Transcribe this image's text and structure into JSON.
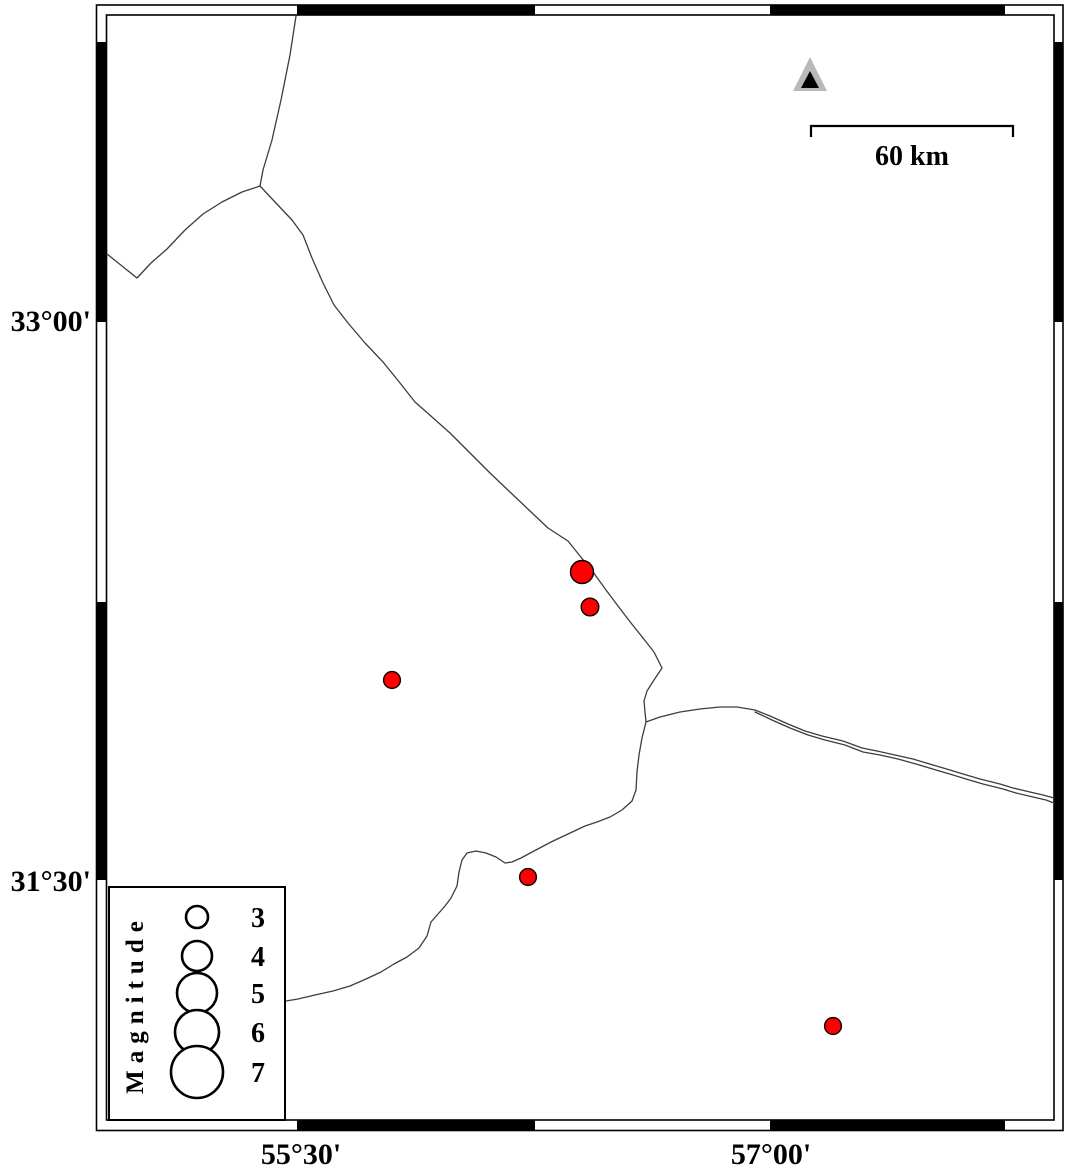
{
  "figure": {
    "width": 1066,
    "height": 1173,
    "background": "#ffffff"
  },
  "map": {
    "frame": {
      "color": "#000000",
      "stroke_width": 1.6,
      "outer": {
        "x1": 96.5,
        "y1": 5,
        "x2": 1063,
        "y2": 1130.5
      },
      "inner": {
        "x1": 106.5,
        "y1": 15,
        "x2": 1054,
        "y2": 1120
      },
      "h_black_segments": [
        [
          297,
          535
        ],
        [
          770,
          1005
        ]
      ],
      "v_black_segments": [
        [
          42,
          322
        ],
        [
          602,
          880
        ]
      ]
    },
    "axis_labels": {
      "left": [
        {
          "text": "33°00'",
          "x": 91,
          "y": 331
        },
        {
          "text": "31°30'",
          "x": 91,
          "y": 891
        }
      ],
      "bottom": [
        {
          "text": "55°30'",
          "x": 301,
          "y": 1164
        },
        {
          "text": "57°00'",
          "x": 771,
          "y": 1164
        }
      ],
      "font_size": 30
    },
    "fault_style": {
      "color": "#3d3d3d",
      "width": 1.3
    },
    "faults": [
      {
        "name": "north-branch",
        "points": [
          [
            296,
            16
          ],
          [
            290,
            55
          ],
          [
            281,
            100
          ],
          [
            272,
            140
          ],
          [
            263,
            170
          ],
          [
            260,
            186
          ]
        ]
      },
      {
        "name": "west-branch",
        "points": [
          [
            107,
            254
          ],
          [
            122,
            266
          ],
          [
            137,
            278
          ],
          [
            151,
            263
          ],
          [
            167,
            249
          ],
          [
            185,
            230
          ],
          [
            203,
            214
          ],
          [
            222,
            202
          ],
          [
            242,
            192
          ],
          [
            260,
            186
          ]
        ]
      },
      {
        "name": "main-diagonal",
        "points": [
          [
            260,
            186
          ],
          [
            275,
            202
          ],
          [
            292,
            220
          ],
          [
            303,
            235
          ],
          [
            312,
            258
          ],
          [
            323,
            283
          ],
          [
            334,
            305
          ],
          [
            348,
            323
          ],
          [
            365,
            343
          ],
          [
            383,
            362
          ],
          [
            400,
            383
          ],
          [
            415,
            402
          ],
          [
            432,
            417
          ],
          [
            450,
            433
          ],
          [
            470,
            453
          ],
          [
            490,
            473
          ],
          [
            510,
            492
          ],
          [
            530,
            511
          ],
          [
            548,
            528
          ],
          [
            568,
            541
          ],
          [
            580,
            556
          ],
          [
            593,
            572
          ],
          [
            606,
            590
          ],
          [
            618,
            606
          ],
          [
            631,
            623
          ],
          [
            643,
            638
          ],
          [
            654,
            652
          ],
          [
            662,
            668
          ],
          [
            654,
            680
          ],
          [
            647,
            691
          ],
          [
            644,
            701
          ],
          [
            645,
            712
          ],
          [
            646,
            722
          ],
          [
            642,
            738
          ],
          [
            639,
            755
          ],
          [
            637,
            772
          ],
          [
            636,
            790
          ],
          [
            632,
            801
          ],
          [
            622,
            810
          ],
          [
            610,
            817
          ],
          [
            597,
            822
          ],
          [
            585,
            826
          ],
          [
            568,
            834
          ],
          [
            551,
            842
          ],
          [
            534,
            851
          ],
          [
            521,
            858
          ],
          [
            512,
            862
          ],
          [
            505,
            863
          ],
          [
            496,
            857
          ],
          [
            486,
            853
          ],
          [
            476,
            851
          ],
          [
            467,
            853
          ],
          [
            462,
            860
          ],
          [
            459,
            872
          ],
          [
            457,
            886
          ],
          [
            451,
            898
          ],
          [
            445,
            906
          ],
          [
            438,
            914
          ],
          [
            431,
            922
          ],
          [
            427,
            936
          ],
          [
            419,
            948
          ],
          [
            407,
            957
          ],
          [
            394,
            964
          ],
          [
            381,
            972
          ],
          [
            366,
            979
          ],
          [
            350,
            986
          ],
          [
            333,
            991
          ],
          [
            315,
            995
          ],
          [
            298,
            999
          ],
          [
            286,
            1001
          ]
        ]
      },
      {
        "name": "east-line",
        "points": [
          [
            646,
            722
          ],
          [
            660,
            717
          ],
          [
            680,
            712
          ],
          [
            700,
            709
          ],
          [
            720,
            707
          ],
          [
            737,
            707
          ],
          [
            755,
            710
          ],
          [
            770,
            716
          ],
          [
            788,
            724
          ],
          [
            805,
            731
          ],
          [
            822,
            736
          ],
          [
            843,
            741
          ],
          [
            862,
            748
          ],
          [
            877,
            751
          ],
          [
            895,
            755
          ],
          [
            913,
            759
          ],
          [
            933,
            765
          ],
          [
            950,
            770
          ],
          [
            963,
            774
          ],
          [
            980,
            779
          ],
          [
            1000,
            784
          ],
          [
            1013,
            788
          ],
          [
            1030,
            792
          ],
          [
            1043,
            795
          ],
          [
            1054,
            798
          ]
        ]
      },
      {
        "name": "east-line-parallel",
        "points": [
          [
            755,
            712
          ],
          [
            772,
            720
          ],
          [
            790,
            728
          ],
          [
            808,
            735
          ],
          [
            825,
            740
          ],
          [
            845,
            745
          ],
          [
            863,
            752
          ],
          [
            880,
            755
          ],
          [
            898,
            759
          ],
          [
            916,
            764
          ],
          [
            936,
            770
          ],
          [
            953,
            775
          ],
          [
            966,
            779
          ],
          [
            983,
            784
          ],
          [
            1003,
            789
          ],
          [
            1016,
            793
          ],
          [
            1033,
            797
          ],
          [
            1046,
            800
          ],
          [
            1054,
            803
          ]
        ]
      }
    ],
    "earthquake_style": {
      "fill": "#ff0000",
      "stroke": "#000000",
      "stroke_width": 1.4
    },
    "earthquakes": [
      {
        "x": 582,
        "y": 572,
        "r": 11.5
      },
      {
        "x": 590,
        "y": 607,
        "r": 8.8
      },
      {
        "x": 392,
        "y": 680,
        "r": 8.4
      },
      {
        "x": 528,
        "y": 877,
        "r": 8.4
      },
      {
        "x": 833,
        "y": 1026,
        "r": 8.4
      }
    ],
    "station": {
      "outer_points": "810,57 793,91 827,91",
      "outer_fill": "#b9b9b9",
      "inner_points": "810,71 801,88 819,88",
      "inner_fill": "#000000"
    },
    "scale_bar": {
      "x1": 811,
      "x2": 1013,
      "y": 126,
      "tick_drop": 11,
      "stroke_width": 2.2,
      "label": "60 km",
      "label_x": 912,
      "label_y": 165,
      "font_size": 28
    },
    "legend": {
      "box": {
        "x": 109,
        "y": 887,
        "w": 176,
        "h": 233,
        "stroke_width": 2
      },
      "title": "Magnitude",
      "title_x": 143,
      "title_y": 1004,
      "title_font_size": 25,
      "title_letter_spacing": 7,
      "circle_cx": 197,
      "circle_stroke_width": 2.6,
      "value_x": 258,
      "value_font_size": 28,
      "entries": [
        {
          "label": "3",
          "cy": 917,
          "r": 11
        },
        {
          "label": "4",
          "cy": 956,
          "r": 15
        },
        {
          "label": "5",
          "cy": 993,
          "r": 20
        },
        {
          "label": "6",
          "cy": 1032,
          "r": 22
        },
        {
          "label": "7",
          "cy": 1072,
          "r": 26
        }
      ]
    }
  },
  "chart_data": {
    "type": "scatter",
    "title": "",
    "notes": "Seismicity map with fault traces; symbol size scales with magnitude",
    "x_axis": {
      "label": "longitude",
      "ticks": [
        "55°30'",
        "57°00'"
      ]
    },
    "y_axis": {
      "label": "latitude",
      "ticks": [
        "33°00'",
        "31°30'"
      ]
    },
    "scale_bar_km": 60,
    "legend": {
      "title": "Magnitude",
      "sizes": [
        3,
        4,
        5,
        6,
        7
      ]
    },
    "series": [
      {
        "name": "earthquake-epicenters",
        "marker": "red-circle",
        "points_px": [
          [
            582,
            572
          ],
          [
            590,
            607
          ],
          [
            392,
            680
          ],
          [
            528,
            877
          ],
          [
            833,
            1026
          ]
        ]
      },
      {
        "name": "station",
        "marker": "gray-black-triangle",
        "points_px": [
          [
            810,
            79
          ]
        ]
      }
    ]
  }
}
